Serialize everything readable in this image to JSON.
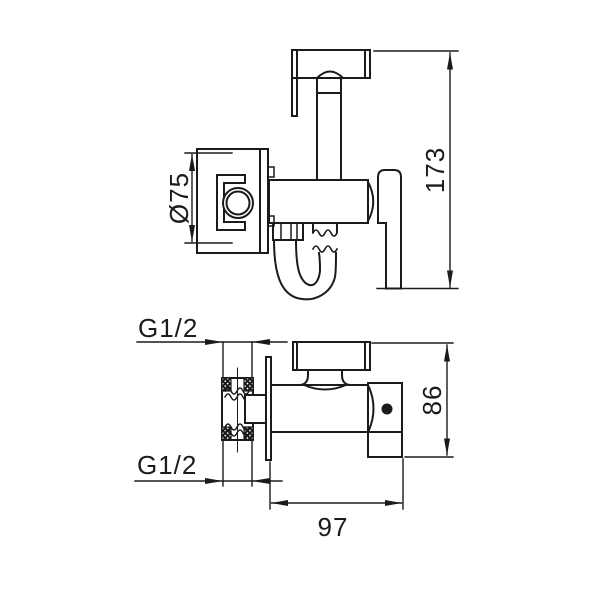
{
  "drawing": {
    "type": "technical-drawing",
    "views": {
      "elevation": "side view of wall-mounted bidet sprayer with holder plate, valve body, lever and hose",
      "plan": "top view of valve body with threaded inlet, wall plate and sprayer holder"
    },
    "dimensions": {
      "bracket_diameter": "Ø75",
      "overall_height": "173",
      "thread_top": "G1/2",
      "thread_bottom": "G1/2",
      "depth": "86",
      "length": "97"
    }
  },
  "colors": {
    "line": "#1b1b1b",
    "background": "#ffffff"
  }
}
